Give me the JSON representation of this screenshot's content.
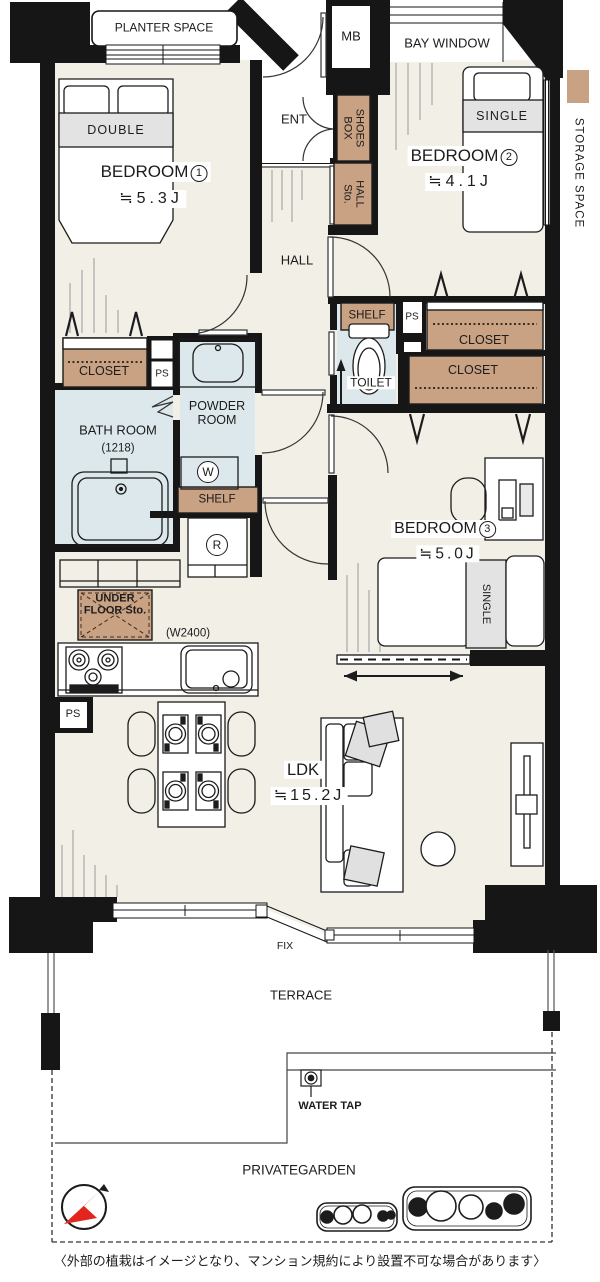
{
  "colors": {
    "wall": "#161616",
    "floor": "#f2efe7",
    "wet_area": "#dce8ec",
    "storage": "#c9a183",
    "bed_band": "#e3e3e3",
    "compass_red": "#e3251d"
  },
  "legend": {
    "storage_label": "STORAGE SPACE"
  },
  "outdoor": {
    "planter_space": "PLANTER SPACE",
    "bay_window": "BAY WINDOW",
    "mb": "MB",
    "fix": "FIX",
    "terrace": "TERRACE",
    "water_tap": "WATER TAP",
    "private_garden": "PRIVATEGARDEN"
  },
  "entrance": {
    "ent": "ENT",
    "shoes_box": [
      "SHOES",
      "BOX"
    ],
    "hall_storage": [
      "HALL",
      "Sto."
    ],
    "hall": "HALL"
  },
  "bedroom1": {
    "name": "BEDROOM",
    "number": "1",
    "size": "≒5.3J",
    "bed": "DOUBLE",
    "closet": "CLOSET",
    "ps": "PS"
  },
  "bedroom2": {
    "name": "BEDROOM",
    "number": "2",
    "size": "≒4.1J",
    "bed": "SINGLE",
    "closet": "CLOSET"
  },
  "bedroom3": {
    "name": "BEDROOM",
    "number": "3",
    "size": "≒5.0J",
    "bed": "SINGLE",
    "closet": "CLOSET"
  },
  "sanitary": {
    "bath_name": "BATH ROOM",
    "bath_size": "(1218)",
    "powder": [
      "POWDER",
      "ROOM"
    ],
    "washer": "W",
    "shelf": "SHELF",
    "toilet": "TOILET",
    "toilet_shelf": "SHELF",
    "toilet_ps": "PS"
  },
  "kitchen": {
    "fridge": "R",
    "under_floor": [
      "UNDER",
      "FLOOR Sto."
    ],
    "width": "(W2400)",
    "ps": "PS"
  },
  "living": {
    "name": "LDK",
    "size": "≒15.2J"
  },
  "caption": "〈外部の植栽はイメージとなり、マンション規約により設置不可な場合があります〉"
}
